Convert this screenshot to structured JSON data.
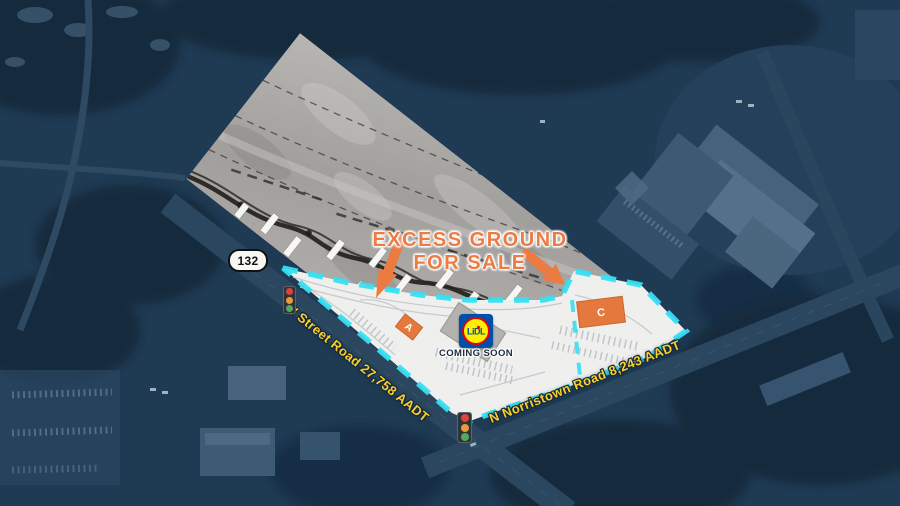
{
  "map": {
    "banner": {
      "line1": "EXCESS GROUND",
      "line2": "FOR SALE"
    },
    "route_shield": {
      "number": "132"
    },
    "roads": [
      {
        "label": "W Street Road 27,758 AADT"
      },
      {
        "label": "N Norristown Road 8,243 AADT"
      }
    ],
    "parcels": [
      {
        "label": "A"
      },
      {
        "label": "C"
      }
    ],
    "anchor": {
      "brand": "LiDL",
      "status": "COMING SOON"
    },
    "legend": {
      "boundary_color": "#36DFF2",
      "accent_orange": "#EC7B42",
      "road_label_yellow": "#F8CF2B",
      "lidl_blue": "#0050AA",
      "lidl_yellow": "#FFF000",
      "lidl_red": "#E3000F",
      "aerial_navy": "#1F3A53"
    }
  }
}
